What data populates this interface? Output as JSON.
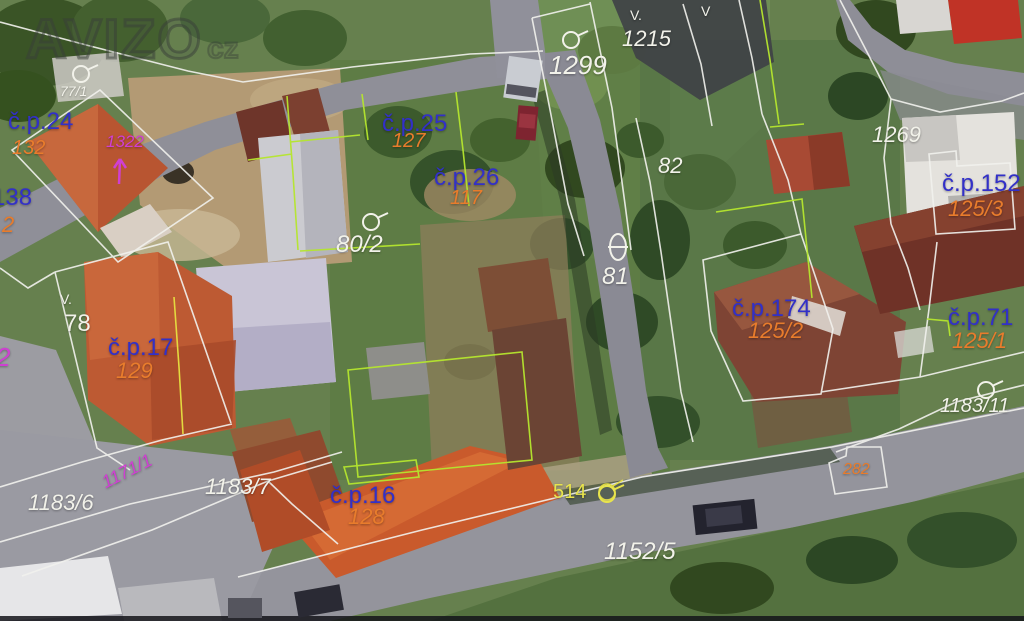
{
  "watermark": {
    "text": "AVIZO",
    "suffix": "cz"
  },
  "palette": {
    "white": "#f2f2ea",
    "blue": "#3230c8",
    "orange": "#e87c2c",
    "magenta": "#cf3fd2",
    "yellow": "#e8e44c"
  },
  "line_colors": {
    "parcel_boundary": "#f2f2ee",
    "building_outline": "#b5e62e",
    "other_boundary": "#e6e040"
  },
  "labels": [
    {
      "id": "p77-1",
      "text": "77/1",
      "x": 60,
      "y": 84,
      "size": 14,
      "color": "white",
      "italic": true
    },
    {
      "id": "cp24",
      "text": "č.p.24",
      "x": 8,
      "y": 110,
      "size": 24,
      "color": "blue"
    },
    {
      "id": "p132",
      "text": "132",
      "x": 12,
      "y": 138,
      "size": 20,
      "color": "orange",
      "italic": true
    },
    {
      "id": "p1322",
      "text": "1322",
      "x": 106,
      "y": 133,
      "size": 17,
      "color": "magenta",
      "italic": true
    },
    {
      "id": "p138",
      "text": "138",
      "x": -8,
      "y": 186,
      "size": 24,
      "color": "blue"
    },
    {
      "id": "p138b",
      "text": "2",
      "x": 2,
      "y": 214,
      "size": 22,
      "color": "orange",
      "italic": true
    },
    {
      "id": "p1299",
      "text": "1299",
      "x": 549,
      "y": 52,
      "size": 26,
      "color": "white",
      "italic": true
    },
    {
      "id": "p1215",
      "text": "1215",
      "x": 622,
      "y": 28,
      "size": 22,
      "color": "white",
      "italic": true
    },
    {
      "id": "p82",
      "text": "82",
      "x": 658,
      "y": 155,
      "size": 22,
      "color": "white",
      "italic": true
    },
    {
      "id": "p1269",
      "text": "1269",
      "x": 872,
      "y": 124,
      "size": 22,
      "color": "white",
      "italic": true
    },
    {
      "id": "cp152",
      "text": "č.p.152",
      "x": 942,
      "y": 172,
      "size": 24,
      "color": "blue"
    },
    {
      "id": "p125-3",
      "text": "125/3",
      "x": 948,
      "y": 198,
      "size": 22,
      "color": "orange",
      "italic": true
    },
    {
      "id": "cp25",
      "text": "č.p.25",
      "x": 382,
      "y": 112,
      "size": 24,
      "color": "blue"
    },
    {
      "id": "p127",
      "text": "127",
      "x": 392,
      "y": 131,
      "size": 20,
      "color": "orange",
      "italic": true
    },
    {
      "id": "cp26",
      "text": "č.p.26",
      "x": 434,
      "y": 166,
      "size": 24,
      "color": "blue"
    },
    {
      "id": "p117",
      "text": "117",
      "x": 450,
      "y": 188,
      "size": 20,
      "color": "orange",
      "italic": true
    },
    {
      "id": "p80-2",
      "text": "80/2",
      "x": 336,
      "y": 233,
      "size": 24,
      "color": "white",
      "italic": true
    },
    {
      "id": "p81",
      "text": "81",
      "x": 602,
      "y": 265,
      "size": 24,
      "color": "white",
      "italic": true
    },
    {
      "id": "cp174",
      "text": "č.p.174",
      "x": 732,
      "y": 297,
      "size": 24,
      "color": "blue"
    },
    {
      "id": "p125-2",
      "text": "125/2",
      "x": 748,
      "y": 320,
      "size": 22,
      "color": "orange",
      "italic": true
    },
    {
      "id": "cp71",
      "text": "č.p.71",
      "x": 948,
      "y": 306,
      "size": 24,
      "color": "blue"
    },
    {
      "id": "p125-1",
      "text": "125/1",
      "x": 952,
      "y": 330,
      "size": 22,
      "color": "orange",
      "italic": true
    },
    {
      "id": "p1183-11",
      "text": "1183/11",
      "x": 940,
      "y": 396,
      "size": 20,
      "color": "white",
      "italic": true
    },
    {
      "id": "p78",
      "text": "78",
      "x": 64,
      "y": 312,
      "size": 24,
      "color": "white"
    },
    {
      "id": "cp17",
      "text": "č.p.17",
      "x": 108,
      "y": 336,
      "size": 24,
      "color": "blue"
    },
    {
      "id": "p129",
      "text": "129",
      "x": 116,
      "y": 360,
      "size": 22,
      "color": "orange",
      "italic": true
    },
    {
      "id": "p2-left",
      "text": "2",
      "x": -4,
      "y": 344,
      "size": 26,
      "color": "magenta",
      "italic": true
    },
    {
      "id": "p1183-6",
      "text": "1183/6",
      "x": 28,
      "y": 492,
      "size": 22,
      "color": "white",
      "italic": true
    },
    {
      "id": "p1171-1",
      "text": "1171/1",
      "x": 100,
      "y": 462,
      "size": 18,
      "color": "magenta",
      "italic": true,
      "rotate": -27
    },
    {
      "id": "p1183-7",
      "text": "1183/7",
      "x": 205,
      "y": 476,
      "size": 22,
      "color": "white",
      "italic": true
    },
    {
      "id": "cp16",
      "text": "č.p.16",
      "x": 330,
      "y": 484,
      "size": 24,
      "color": "blue"
    },
    {
      "id": "p128",
      "text": "128",
      "x": 348,
      "y": 506,
      "size": 22,
      "color": "orange",
      "italic": true
    },
    {
      "id": "p514",
      "text": "514",
      "x": 553,
      "y": 482,
      "size": 20,
      "color": "yellow"
    },
    {
      "id": "p282",
      "text": "282",
      "x": 843,
      "y": 462,
      "size": 16,
      "color": "orange",
      "italic": true
    },
    {
      "id": "p1152-5",
      "text": "1152/5",
      "x": 604,
      "y": 540,
      "size": 24,
      "color": "white",
      "italic": true
    }
  ],
  "symbols": [
    {
      "type": "orchard",
      "x": 70,
      "y": 60,
      "color": "white"
    },
    {
      "type": "orchard",
      "x": 560,
      "y": 26,
      "color": "white"
    },
    {
      "type": "orchard",
      "x": 360,
      "y": 208,
      "color": "white"
    },
    {
      "type": "orchard",
      "x": 975,
      "y": 376,
      "color": "white"
    },
    {
      "type": "orchard",
      "x": 596,
      "y": 480,
      "color": "yellow"
    },
    {
      "type": "theta",
      "x": 606,
      "y": 230,
      "color": "white"
    },
    {
      "type": "conifer",
      "glyph": "V.",
      "x": 630,
      "y": 8,
      "color": "white"
    },
    {
      "type": "conifer",
      "glyph": "V.",
      "x": 60,
      "y": 292,
      "color": "white"
    },
    {
      "type": "conifer",
      "glyph": "V",
      "x": 701,
      "y": 4,
      "color": "white"
    },
    {
      "type": "arrow",
      "x": 110,
      "y": 152,
      "color": "magenta"
    }
  ]
}
